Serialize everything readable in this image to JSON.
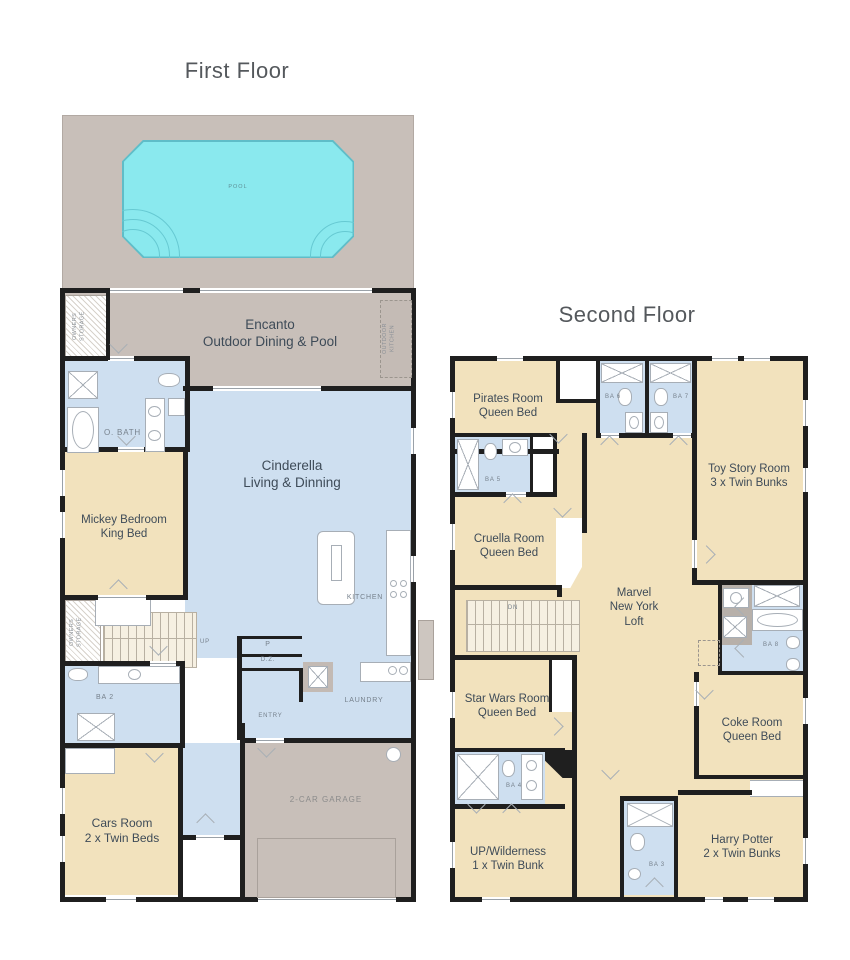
{
  "colors": {
    "wall": "#1f1f1f",
    "bedroom_tan": "#f2e2bd",
    "living_blue": "#cedff0",
    "patio_gray": "#c8bfb9",
    "pool_cyan": "#8ae9ee",
    "label_dark": "#3e4b58",
    "label_muted": "#76818c"
  },
  "ff": {
    "title": "First Floor",
    "pool": "POOL",
    "lanai": "Encanto\nOutdoor Dining & Pool",
    "storage": "OWNERS\nSTORAGE",
    "outdoor_kitchen": "OUTDOOR\nKITCHEN",
    "obath": "O. BATH",
    "mickey": "Mickey Bedroom\nKing Bed",
    "cinderella": "Cinderella\nLiving & Dinning",
    "kitchen": "KITCHEN",
    "up": "UP",
    "storage2": "OWNERS\nSTORAGE",
    "ba2": "BA 2",
    "p": "P",
    "dz": "D.Z.",
    "entry": "ENTRY",
    "laundry": "LAUNDRY",
    "cars": "Cars Room\n2 x Twin Beds",
    "garage": "2-CAR GARAGE"
  },
  "sf": {
    "title": "Second Floor",
    "pirates": "Pirates Room\nQueen Bed",
    "ba6": "BA 6",
    "ba7": "BA 7",
    "toystory": "Toy Story Room\n3 x Twin Bunks",
    "ba5": "BA 5",
    "cruella": "Cruella Room\nQueen Bed",
    "marvel": "Marvel\nNew York\nLoft",
    "dn": "DN",
    "ba8": "BA 8",
    "starwars": "Star Wars Room\nQueen Bed",
    "coke": "Coke Room\nQueen Bed",
    "ba4": "BA 4",
    "wild": "UP/Wilderness\n1 x Twin Bunk",
    "ba3": "BA 3",
    "harry": "Harry Potter\n2 x Twin Bunks"
  }
}
